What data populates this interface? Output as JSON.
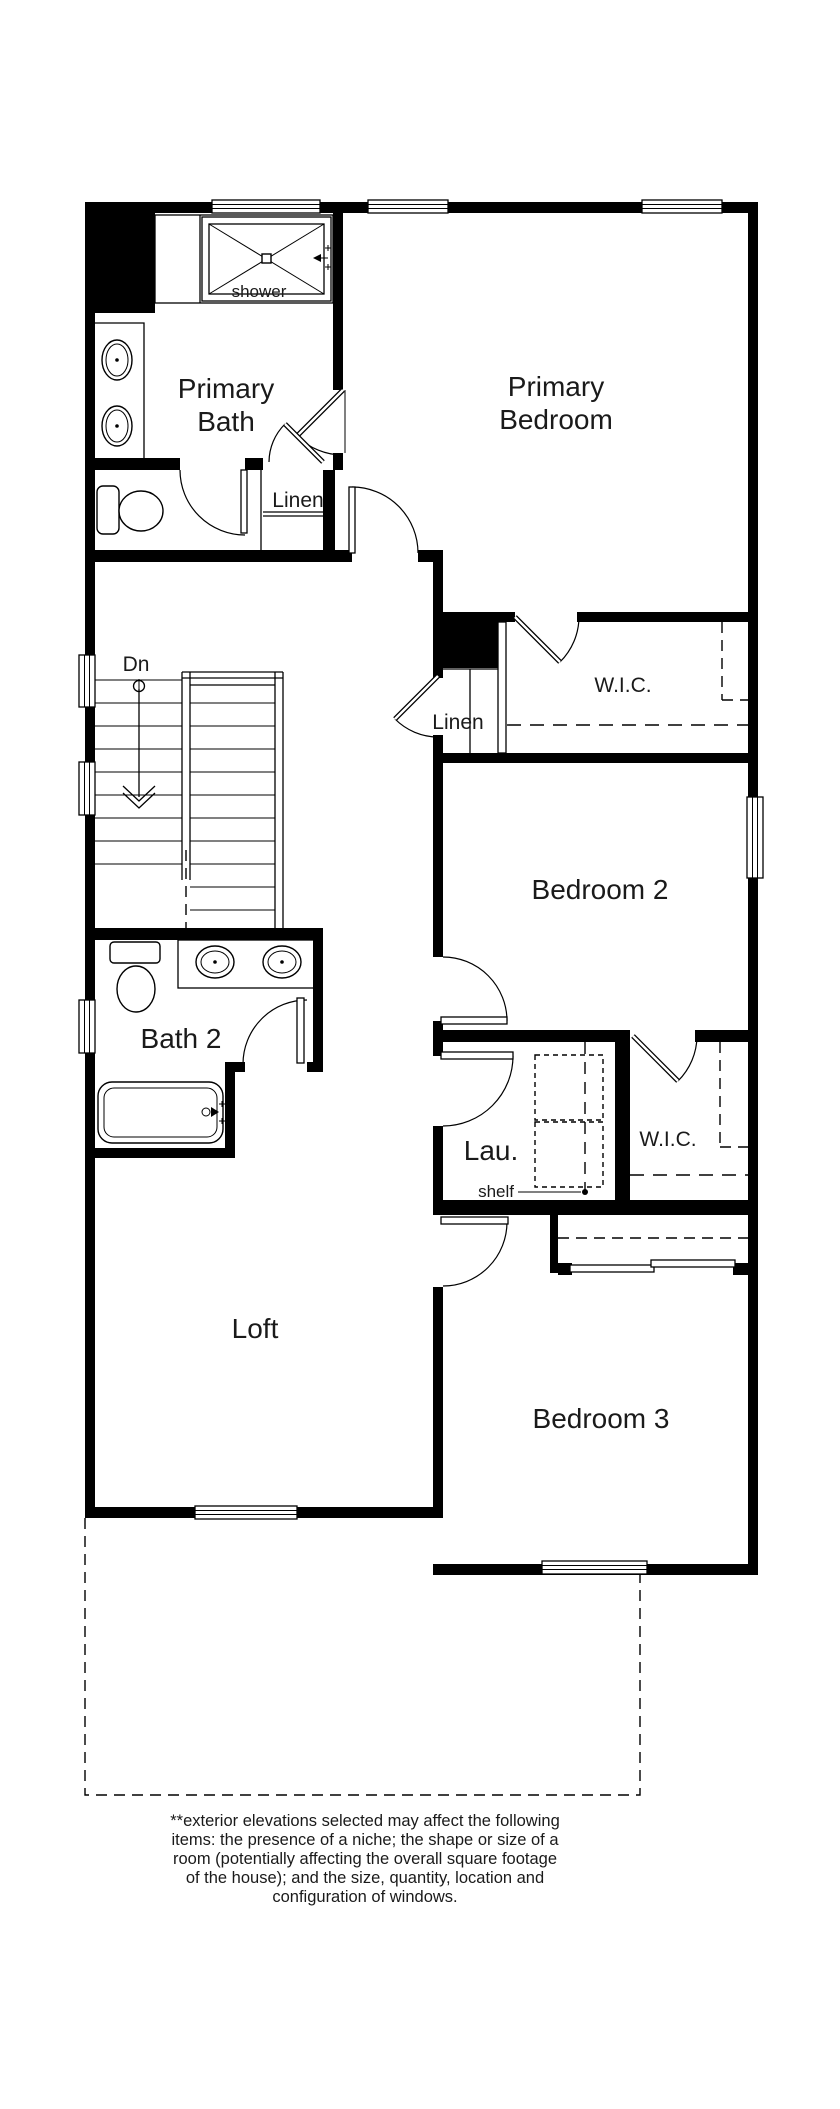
{
  "plan": {
    "colors": {
      "wall": "#000000",
      "background": "#ffffff",
      "text": "#1a1a1a"
    },
    "rooms": {
      "primary_bath": {
        "label": "Primary Bath",
        "lines": [
          "Primary",
          "Bath"
        ]
      },
      "primary_bedroom": {
        "label": "Primary Bedroom",
        "lines": [
          "Primary",
          "Bedroom"
        ]
      },
      "bedroom2": {
        "label": "Bedroom 2"
      },
      "bedroom3": {
        "label": "Bedroom 3"
      },
      "bath2": {
        "label": "Bath 2"
      },
      "loft": {
        "label": "Loft"
      },
      "laundry": {
        "label": "Lau."
      },
      "wic1": {
        "label": "W.I.C."
      },
      "wic2": {
        "label": "W.I.C."
      },
      "linen1": {
        "label": "Linen"
      },
      "linen2": {
        "label": "Linen"
      }
    },
    "annotations": {
      "shower": "shower",
      "shelf": "shelf",
      "stairs_down": "Dn"
    },
    "disclaimer": {
      "lines": [
        "**exterior elevations selected may affect the following",
        "items: the presence of a niche; the shape or size of a",
        "room (potentially affecting the overall square footage",
        "of the house); and the size, quantity, location and",
        "configuration of windows."
      ]
    }
  }
}
